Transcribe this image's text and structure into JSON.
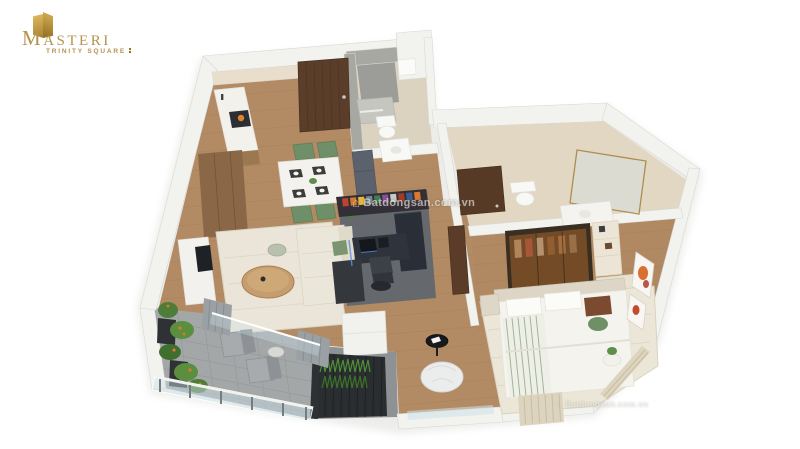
{
  "page": {
    "background": "#ffffff",
    "width": 800,
    "height": 449
  },
  "logo": {
    "title": "MASTERI",
    "subtitle": "TRINITY SQUARE",
    "mark_icon": "masteri-gold-monogram",
    "color_primary": "#b5924c",
    "color_mark_light": "#d9b258",
    "color_mark_dark": "#8f6d22"
  },
  "watermark": {
    "text": "Batdongsan.com.vn",
    "icon": "house-icon",
    "color": "#8b8578"
  },
  "floorplan": {
    "type": "3d-isometric-apartment-floor-plan-render",
    "view": "top-down dollhouse cutaway, white background",
    "rooms": [
      {
        "name": "entrance-hall",
        "features": [
          "dark-walnut-entrance-door"
        ]
      },
      {
        "name": "kitchen",
        "features": [
          "counter-with-cooktop",
          "beige-backsplash",
          "tall-wood-cabinet",
          "refrigerator"
        ]
      },
      {
        "name": "dining-area",
        "features": [
          "white-stone-table",
          "four-green-chairs",
          "dark-place-mats",
          "small-plant"
        ]
      },
      {
        "name": "living-room",
        "features": [
          "cream-sofa-with-green-pillows",
          "round-wood-coffee-table",
          "cream-striped-rug",
          "white-tv-console",
          "side-stool"
        ]
      },
      {
        "name": "balcony",
        "features": [
          "glass-balustrade",
          "potted-plants-orange-flowers",
          "two-grey-chairs",
          "small-table",
          "grey-tile-floor",
          "grey-curtains"
        ]
      },
      {
        "name": "home-office-nook",
        "features": [
          "dark-l-shaped-desk",
          "monitors",
          "desk-chair",
          "bookshelf-partition-with-colorful-books",
          "led-strip"
        ]
      },
      {
        "name": "bathroom-1",
        "features": [
          "grey-tiled-walk-in-shower",
          "toilet",
          "washbasin",
          "mirror-cabinet"
        ]
      },
      {
        "name": "bathroom-2",
        "features": [
          "glass-shower-brass-frame",
          "toilet",
          "vanity-with-basin"
        ]
      },
      {
        "name": "dressing-area",
        "features": [
          "amber-glass-wardrobe-with-clothes",
          "open-shelving",
          "vanity-table",
          "stool"
        ]
      },
      {
        "name": "bedroom",
        "features": [
          "double-bed-white-duvet",
          "green-striped-runner",
          "brown-and-green-pillows",
          "headboard",
          "nightstand",
          "round-side-table-with-plant",
          "orange-wall-art",
          "striped-cream-curtains",
          "cream-rug"
        ]
      },
      {
        "name": "window-nook",
        "features": [
          "white-bean-bag",
          "black-round-side-table",
          "grass-planter-screen",
          "white-storage-cabinet",
          "full-height-windows"
        ]
      }
    ],
    "palette": {
      "wood_floor": "#b28a63",
      "walls": "#f2f2ef",
      "balcony_tile": "#a3a7a8",
      "sofa_cream": "#ebe6da",
      "greenery": "#4f8f35",
      "chair_green": "#6f8f68",
      "office_dark": "#2f343c",
      "wardrobe_amber": "#96602c",
      "door_walnut": "#5a3e2a",
      "brass_frame": "#b08d4f",
      "bathroom_tile_grey": "#9c9c98",
      "bathroom_beige": "#e2d7c3"
    }
  }
}
